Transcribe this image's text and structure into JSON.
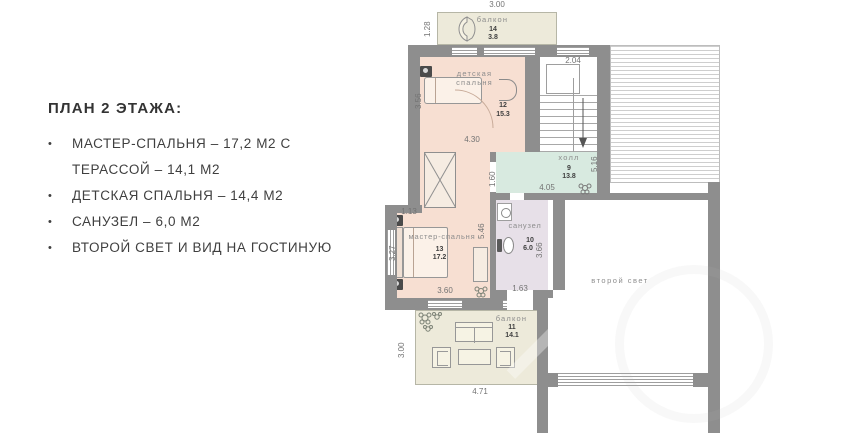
{
  "panel": {
    "heading": "ПЛАН 2 ЭТАЖА:",
    "bullet_char": "•",
    "items": [
      {
        "line1": "МАСТЕР-СПАЛЬНЯ – 17,2 М2 С",
        "line2": "ТЕРАССОЙ – 14,1 М2"
      },
      {
        "line1": "ДЕТСКАЯ СПАЛЬНЯ – 14,4 М2"
      },
      {
        "line1": "САНУЗЕЛ – 6,0 М2"
      },
      {
        "line1": "ВТОРОЙ СВЕТ И ВИД НА ГОСТИНУЮ"
      }
    ]
  },
  "plan": {
    "rooms": {
      "balcony_top": {
        "label": "балкон",
        "num": "14",
        "area": "3.8"
      },
      "nursery": {
        "label": "детская спальня",
        "num": "12",
        "area": "15.3"
      },
      "hall": {
        "label": "холл",
        "num": "9",
        "area": "13.8"
      },
      "bath": {
        "label": "санузел",
        "num": "10",
        "area": "6.0"
      },
      "master": {
        "label": "мастер-спальня",
        "num": "13",
        "area": "17.2"
      },
      "balcony_bottom": {
        "label": "балкон",
        "num": "11",
        "area": "14.1"
      },
      "void": {
        "label": "второй свет"
      }
    },
    "dims": {
      "balcony_top_width": "3.00",
      "balcony_top_depth": "1.28",
      "stair_width": "2.04",
      "nursery_depth": "3.56",
      "nursery_width": "4.30",
      "hall_entry": "1.60",
      "hall_width": "4.05",
      "hall_depth": "5.16",
      "master_step": "1.13",
      "master_height": "5.46",
      "master_depth": "3.27",
      "master_width": "3.60",
      "bath_depth": "3.66",
      "bath_exit": "1.63",
      "balcony_bottom_depth": "3.00",
      "balcony_bottom_width": "4.71"
    },
    "colors": {
      "wall": "#8e8e8e",
      "room_fill": "#f7dfd2",
      "balcony_fill": "#edeada",
      "hall_fill": "#d8eae0",
      "bath_fill": "#e7e0e8"
    }
  }
}
